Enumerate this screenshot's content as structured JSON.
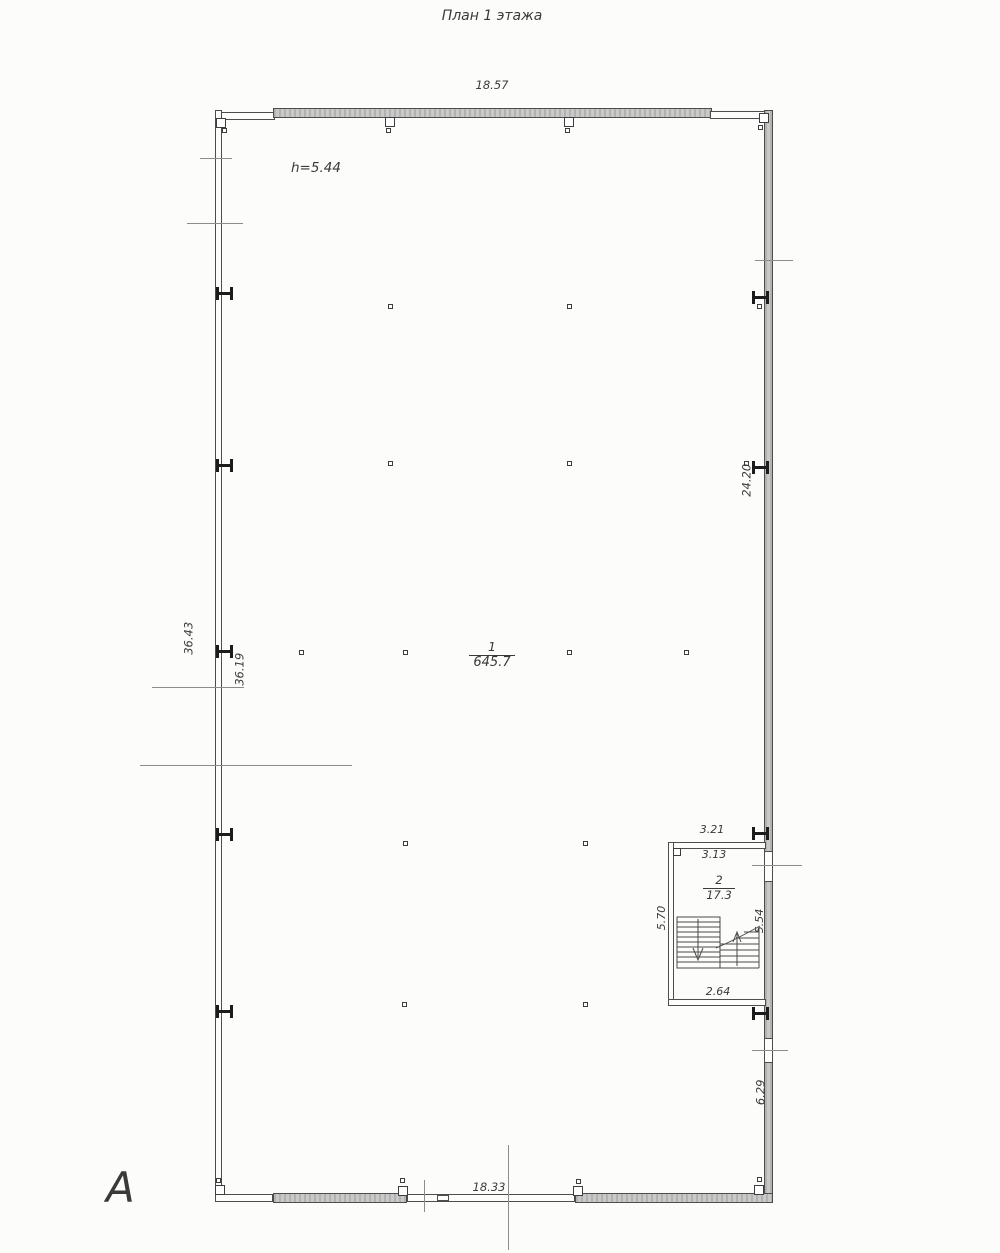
{
  "drawing": {
    "title": "План 1 этажа",
    "ceiling_height": "h=5.44",
    "axis_label": "А"
  },
  "dimensions": {
    "top_width": "18.57",
    "bottom_width": "18.33",
    "left_outer": "36.43",
    "left_inner": "36.19",
    "right_height": "24.20",
    "right_lower": "6.29"
  },
  "room_main": {
    "number": "1",
    "area": "645.7"
  },
  "stairwell": {
    "number": "2",
    "area": "17.3",
    "width_outer": "3.21",
    "width_inner": "3.13",
    "depth_left": "5.70",
    "depth_right": "5.54",
    "landing_width": "2.64"
  }
}
